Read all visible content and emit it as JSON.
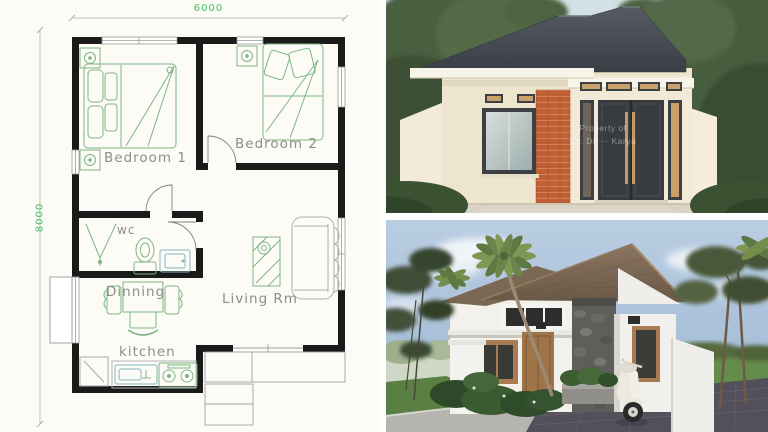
{
  "floor_plan": {
    "dimensions": {
      "width_label": "6000",
      "height_label": "8000"
    },
    "rooms": [
      {
        "label": "Bedroom 1"
      },
      {
        "label": "Bedroom 2"
      },
      {
        "label": "wc"
      },
      {
        "label": "Dinning"
      },
      {
        "label": "Living Rm"
      },
      {
        "label": "kitchen"
      }
    ],
    "colors": {
      "paper": "#fcfbf6",
      "wall": "#1a1a1a",
      "furniture_line": "#7fb583",
      "label_text": "#8d8d8d",
      "dimension_text": "#45c164"
    }
  },
  "render_top": {
    "watermark": {
      "line1": "Property of",
      "line2": "Cv. Di···· Karya"
    },
    "colors": {
      "sky": "#cbd9e2",
      "trees": "#47603e",
      "roof": "#45494f",
      "wall_cream": "#efe6d0",
      "brick_accent": "#bf5f36",
      "door_frame": "#383b40",
      "door_glass_wood": "#c9a26e",
      "ground": "#dbd5c7",
      "hedge": "#3a5132"
    }
  },
  "render_bottom": {
    "colors": {
      "sky": "#b0c5db",
      "cloud": "#ffffff",
      "roof_tile": "#7c6853",
      "wall_white": "#f1f0ec",
      "stone": "#5e5e5a",
      "wood": "#a87c50",
      "lawn": "#648c4b",
      "paver": "#534f5b",
      "curb": "#b6b4af",
      "palm": "#7f9654"
    }
  }
}
